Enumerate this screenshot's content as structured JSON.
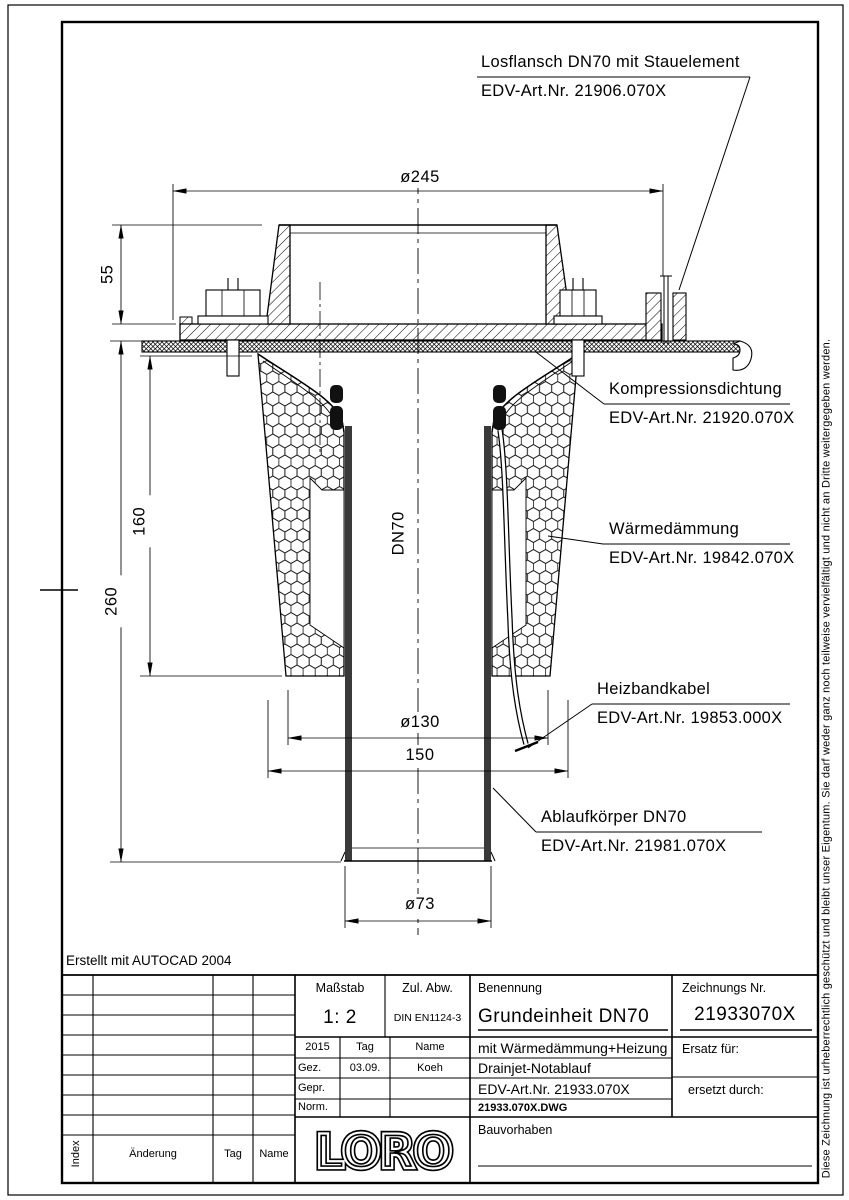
{
  "annotations": {
    "losflansch": {
      "title": "Losflansch DN70 mit Stauelement",
      "art": "EDV-Art.Nr.  21906.070X"
    },
    "kompressionsdichtung": {
      "title": "Kompressionsdichtung",
      "art": "EDV-Art.Nr.  21920.070X"
    },
    "waermedaemmung": {
      "title": "Wärmedämmung",
      "art": "EDV-Art.Nr.  19842.070X"
    },
    "heizbandkabel": {
      "title": "Heizbandkabel",
      "art": "EDV-Art.Nr.  19853.000X"
    },
    "ablaufkoerper": {
      "title": "Ablaufkörper DN70",
      "art": "EDV-Art.Nr.  21981.070X"
    }
  },
  "dimensions": {
    "flange_diameter": "ø245",
    "standpipe_height": "55",
    "insulation_height": "160",
    "total_height": "260",
    "pipe_size": "DN70",
    "insulation_diameter": "ø130",
    "body_width": "150",
    "pipe_outer_diameter": "ø73"
  },
  "notes": {
    "created_with": "Erstellt mit AUTOCAD 2004",
    "copyright": "Diese Zeichnung ist urheberrechtlich geschützt und bleibt unser Eigentum. Sie darf weder ganz noch teilweise vervielfältigt und nicht an Dritte weitergegeben werden."
  },
  "titleblock": {
    "massstab_label": "Maßstab",
    "massstab_value": "1: 2",
    "zul_abw_label": "Zul. Abw.",
    "zul_abw_value": "DIN EN1124-3",
    "benennung_label": "Benennung",
    "benennung_value": "Grundeinheit DN70",
    "zeichnung_label": "Zeichnungs Nr.",
    "zeichnung_value": "21933070X",
    "year": "2015",
    "tag_label": "Tag",
    "name_label": "Name",
    "gez_label": "Gez.",
    "gez_tag": "03.09.",
    "gez_name": "Koeh",
    "gepr_label": "Gepr.",
    "norm_label": "Norm.",
    "desc_line1": "mit Wärmedämmung+Heizung",
    "desc_line2": "Drainjet-Notablauf",
    "edv_art": "EDV-Art.Nr.  21933.070X",
    "dwg_file": "21933.070X.DWG",
    "ersatz_label": "Ersatz für:",
    "ersetzt_label": "ersetzt durch:",
    "bauvorhaben_label": "Bauvorhaben",
    "logo": "LORO"
  },
  "revision_table": {
    "index_label": "Index",
    "aenderung_label": "Änderung",
    "tag_label": "Tag",
    "name_label": "Name"
  }
}
